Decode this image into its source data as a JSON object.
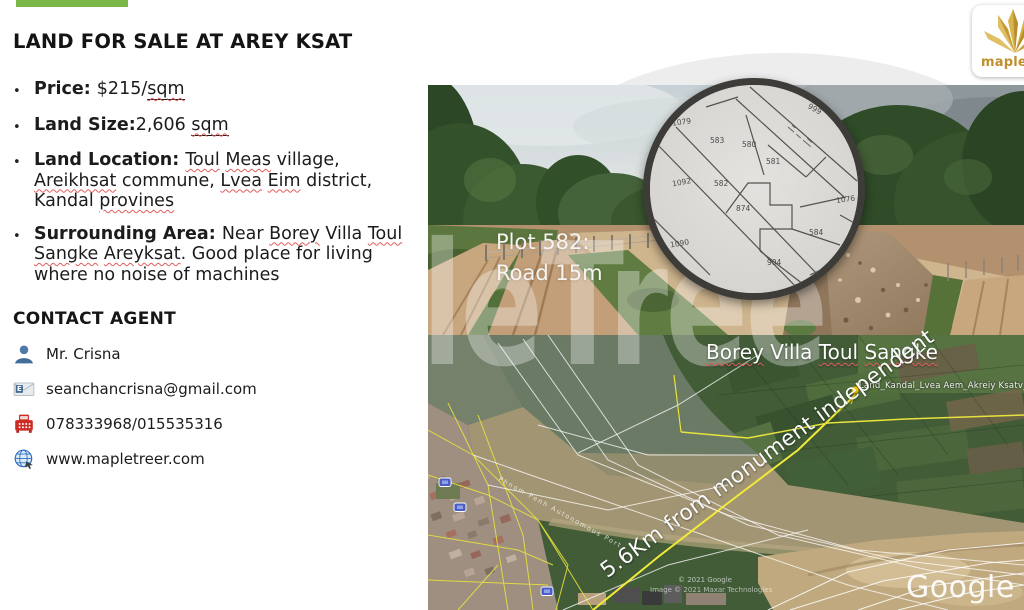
{
  "page": {
    "title": "LAND FOR SALE AT AREY KSAT",
    "watermark": "MapleTree",
    "accent_color": "#7ab648",
    "squiggle_color": "#e25d5d"
  },
  "listing": {
    "bullets": [
      {
        "segments": [
          {
            "t": "Price: ",
            "b": true
          },
          {
            "t": "$215/"
          },
          {
            "t": "sqm",
            "u": true,
            "sq": true
          }
        ]
      },
      {
        "segments": [
          {
            "t": "Land Size:",
            "b": true
          },
          {
            "t": "2,606 "
          },
          {
            "t": "sqm",
            "u": true,
            "sq": true
          }
        ]
      },
      {
        "segments": [
          {
            "t": "Land Location: ",
            "b": true
          },
          {
            "t": "Toul",
            "sq": true
          },
          {
            "t": " "
          },
          {
            "t": "Meas",
            "sq": true
          },
          {
            "t": " village, "
          },
          {
            "t": "Areikhsat",
            "sq": true
          },
          {
            "t": " commune, "
          },
          {
            "t": "Lvea",
            "sq": true
          },
          {
            "t": " "
          },
          {
            "t": "Eim",
            "sq": true
          },
          {
            "t": " district, Kandal "
          },
          {
            "t": "provines",
            "sq": true
          }
        ]
      },
      {
        "segments": [
          {
            "t": "Surrounding Area: ",
            "b": true
          },
          {
            "t": "Near "
          },
          {
            "t": "Borey",
            "sq": true
          },
          {
            "t": " Villa "
          },
          {
            "t": "Toul",
            "sq": true
          },
          {
            "t": " "
          },
          {
            "t": "Sangke",
            "sq": true
          },
          {
            "t": " "
          },
          {
            "t": "Areyksat",
            "sq": true
          },
          {
            "t": ". Good place for living where no noise of machines"
          }
        ]
      }
    ]
  },
  "contact": {
    "heading": "CONTACT AGENT",
    "items": [
      {
        "icon": "person-icon",
        "text": "Mr. Crisna"
      },
      {
        "icon": "email-icon",
        "text": "seanchancrisna@gmail.com"
      },
      {
        "icon": "fax-icon",
        "text": "078333968/015535316"
      },
      {
        "icon": "globe-icon",
        "text": "www.mapletreer.com"
      }
    ]
  },
  "media": {
    "plot_note_line1": "Plot 582:",
    "plot_note_line2": "Road 15m",
    "borey_label_segments": [
      {
        "t": "Borey",
        "sq": true
      },
      {
        "t": " Villa "
      },
      {
        "t": "Toul",
        "sq": true
      },
      {
        "t": " "
      },
      {
        "t": "Sangke",
        "sq": true
      }
    ],
    "pin_label": "Land_Kandal_Lvea Aem_Akreiy Ksatv_260",
    "route_label": "5.6Km from monument independent",
    "river_label": "Phnom Penh Autonomous Port",
    "credit_google": "© 2021 Google",
    "credit_maxar": "Image © 2021 Maxar Technologies",
    "google_watermark": "Google",
    "route_color": "#f2ea3a",
    "pin_color": "#ffd400"
  },
  "plot_map": {
    "numbers": [
      "1079",
      "583",
      "580",
      "581",
      "582",
      "1092",
      "874",
      "1076",
      "584",
      "1090",
      "904",
      "999"
    ]
  },
  "logo": {
    "text": "mapletree",
    "gold": "#c49128"
  }
}
